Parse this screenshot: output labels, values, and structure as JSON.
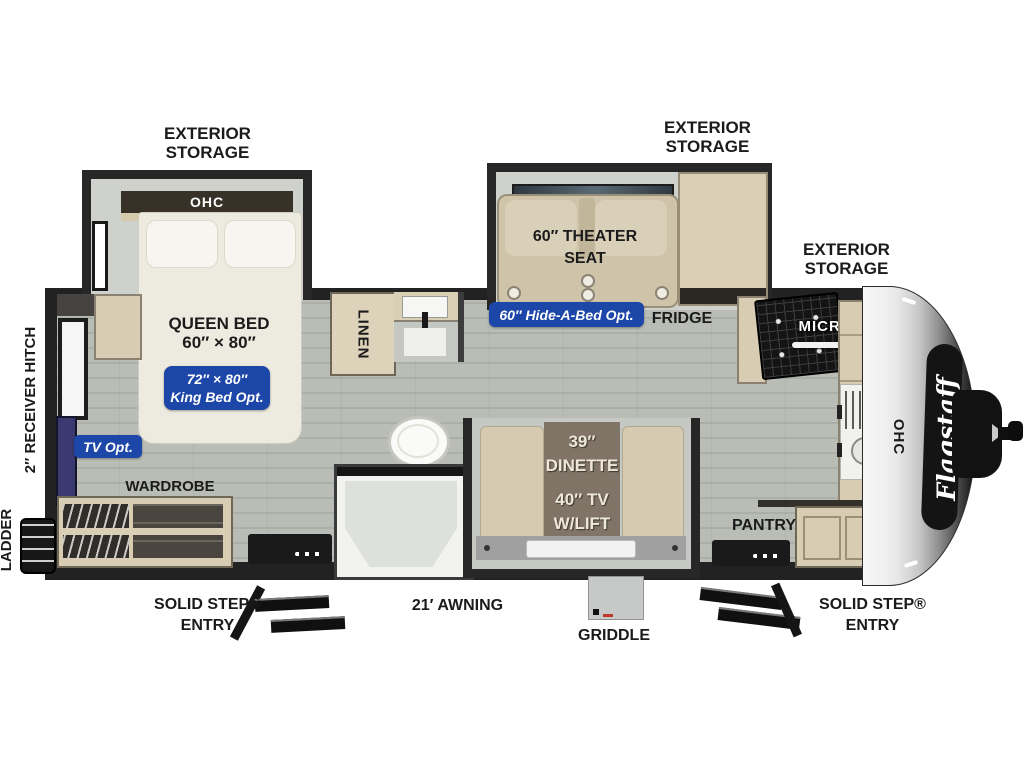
{
  "labels": {
    "exterior_storage": {
      "line1": "EXTERIOR",
      "line2": "STORAGE"
    },
    "bedroom": {
      "ohc": "OHC",
      "queen_line1": "QUEEN BED",
      "queen_line2": "60″ × 80″",
      "king_opt_line1": "72″ × 80″",
      "king_opt_line2": "King Bed Opt.",
      "tv_opt": "TV Opt.",
      "wardrobe": "WARDROBE"
    },
    "bath": {
      "linen": "LINEN"
    },
    "living": {
      "theater_line1": "60″ THEATER",
      "theater_line2": "SEAT",
      "hide_a_bed": "60″ Hide-A-Bed Opt.",
      "fridge": "FRIDGE",
      "dinette_size": "39″",
      "dinette": "DINETTE",
      "tv_line1": "40″ TV",
      "tv_line2": "W/LIFT"
    },
    "kitchen": {
      "micro": "MICRO",
      "pantry": "PANTRY",
      "ohc": "OHC"
    },
    "exterior": {
      "receiver_hitch": "2″ RECEIVER HITCH",
      "ladder": "LADDER",
      "solid_step_line1": "SOLID STEP®",
      "solid_step_line2": "ENTRY",
      "awning": "21′ AWNING",
      "griddle": "GRIDDLE"
    },
    "brand": "Flagstaff"
  },
  "colors": {
    "badge_blue": "#1c46a8",
    "wall_dark": "#222222",
    "wood_tan": "#d8cdb2",
    "floor_gray": "#b9bdb5"
  }
}
